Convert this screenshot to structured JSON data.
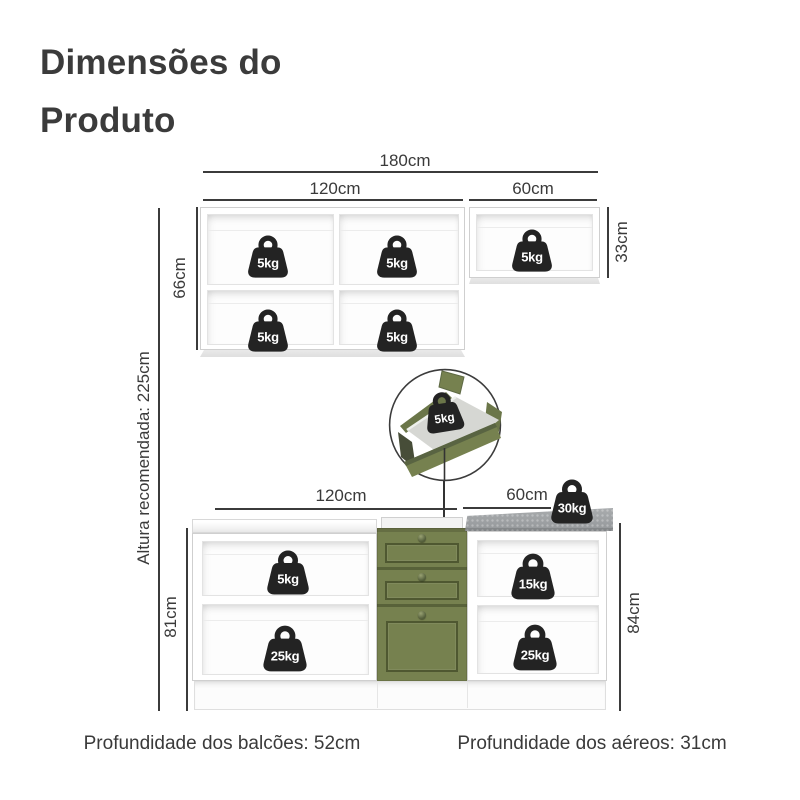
{
  "title": "Dimensões do Produto",
  "upper": {
    "dim_total": "180cm",
    "dim_left_width": "120cm",
    "dim_right_width": "60cm",
    "dim_left_height": "66cm",
    "dim_right_height": "33cm",
    "weights": {
      "top_left": "5kg",
      "top_middle": "5kg",
      "top_right": "5kg",
      "bottom_left": "5kg",
      "bottom_middle": "5kg"
    }
  },
  "callout": {
    "drawer_weight": "5kg"
  },
  "recommended_height": "Altura recomendada: 225cm",
  "lower": {
    "dim_left_width": "120cm",
    "dim_right_width": "60cm",
    "dim_left_height": "81cm",
    "dim_right_height": "84cm",
    "weights": {
      "left_top": "5kg",
      "left_bottom": "25kg",
      "right_top": "15kg",
      "right_bottom": "25kg",
      "countertop": "30kg"
    }
  },
  "footer": {
    "counters_depth": "Profundidade dos balcões: 52cm",
    "uppers_depth": "Profundidade dos aéreos: 31cm"
  },
  "colors": {
    "green": "#76814F",
    "green-dark": "#5C6741",
    "countertop": "#9C9FA2",
    "icon": "#232323",
    "text": "#3A3A3A",
    "line": "#3B3B3B"
  }
}
